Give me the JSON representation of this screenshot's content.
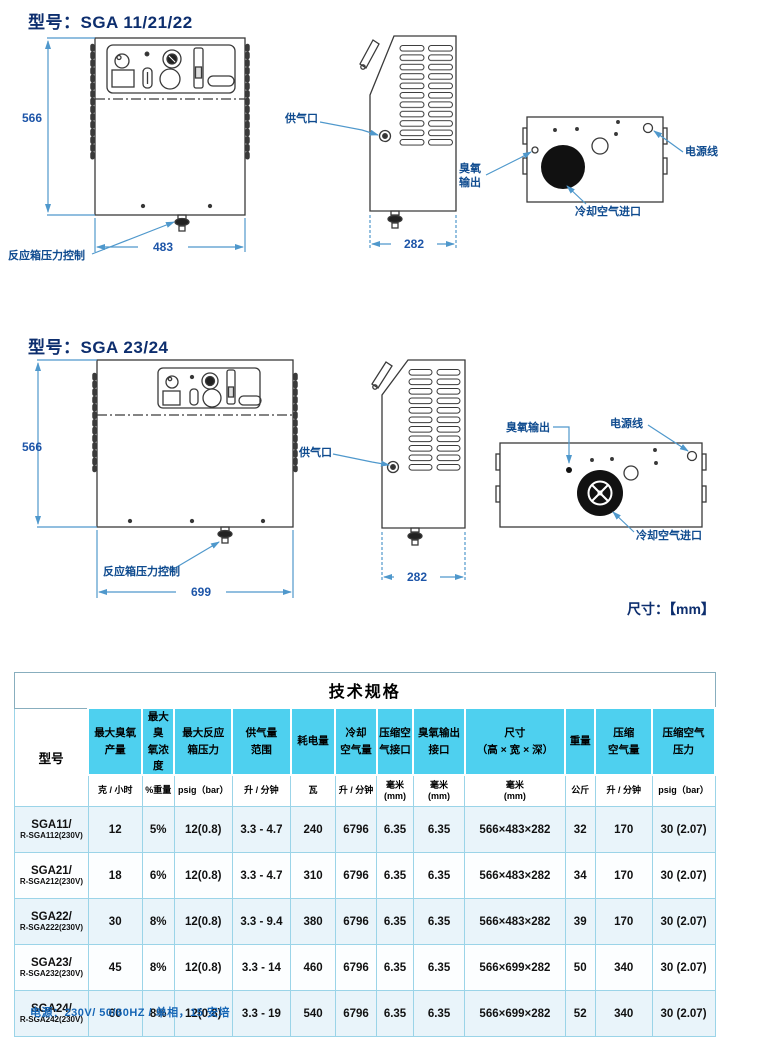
{
  "section1": {
    "title": "型号：SGA 11/21/22",
    "dim_height": "566",
    "dim_width": "483",
    "dim_depth": "282",
    "label_pressure": "反应箱压力控制",
    "label_air_inlet": "供气口",
    "label_ozone_out": "臭氧\n输出",
    "label_power_cord": "电源线",
    "label_cooling_inlet": "冷却空气进口"
  },
  "section2": {
    "title": "型号：SGA 23/24",
    "dim_height": "566",
    "dim_width": "699",
    "dim_depth": "282",
    "label_pressure": "反应箱压力控制",
    "label_air_inlet": "供气口",
    "label_ozone_out": "臭氧输出",
    "label_power_cord": "电源线",
    "label_cooling_inlet": "冷却空气进口"
  },
  "units_note": "尺寸：【mm】",
  "table": {
    "title": "技术规格",
    "columns": [
      {
        "name": "型号",
        "unit": ""
      },
      {
        "name": "最大臭氧\n产量",
        "unit": "克 / 小时"
      },
      {
        "name": "最大臭\n氧浓度",
        "unit": "%重量"
      },
      {
        "name": "最大反应\n箱压力",
        "unit": "psig（bar）"
      },
      {
        "name": "供气量\n范围",
        "unit": "升 / 分钟"
      },
      {
        "name": "耗电量",
        "unit": "瓦"
      },
      {
        "name": "冷却\n空气量",
        "unit": "升 / 分钟"
      },
      {
        "name": "压缩空\n气接口",
        "unit": "毫米\n(mm)"
      },
      {
        "name": "臭氧输出\n接口",
        "unit": "毫米\n(mm)"
      },
      {
        "name": "尺寸\n（高 × 宽 × 深）",
        "unit": "毫米\n(mm)"
      },
      {
        "name": "重量",
        "unit": "公斤"
      },
      {
        "name": "压缩\n空气量",
        "unit": "升 / 分钟"
      },
      {
        "name": "压缩空气\n压力",
        "unit": "psig（bar）"
      }
    ],
    "rows": [
      {
        "model_line1": "SGA11/",
        "model_line2": "R-SGA112(230V)",
        "values": [
          "12",
          "5%",
          "12(0.8)",
          "3.3 - 4.7",
          "240",
          "6796",
          "6.35",
          "6.35",
          "566×483×282",
          "32",
          "170",
          "30 (2.07)"
        ]
      },
      {
        "model_line1": "SGA21/",
        "model_line2": "R-SGA212(230V)",
        "values": [
          "18",
          "6%",
          "12(0.8)",
          "3.3 - 4.7",
          "310",
          "6796",
          "6.35",
          "6.35",
          "566×483×282",
          "34",
          "170",
          "30 (2.07)"
        ]
      },
      {
        "model_line1": "SGA22/",
        "model_line2": "R-SGA222(230V)",
        "values": [
          "30",
          "8%",
          "12(0.8)",
          "3.3 - 9.4",
          "380",
          "6796",
          "6.35",
          "6.35",
          "566×483×282",
          "39",
          "170",
          "30 (2.07)"
        ]
      },
      {
        "model_line1": "SGA23/",
        "model_line2": "R-SGA232(230V)",
        "values": [
          "45",
          "8%",
          "12(0.8)",
          "3.3 - 14",
          "460",
          "6796",
          "6.35",
          "6.35",
          "566×699×282",
          "50",
          "340",
          "30 (2.07)"
        ]
      },
      {
        "model_line1": "SGA24/",
        "model_line2": "R-SGA242(230V)",
        "values": [
          "60",
          "8%",
          "12(0.8)",
          "3.3 - 19",
          "540",
          "6796",
          "6.35",
          "6.35",
          "566×699×282",
          "52",
          "340",
          "30 (2.07)"
        ]
      }
    ]
  },
  "footer_note": "电源：230V/ 50/60HZ / 单相，15 安培",
  "colors": {
    "title_blue": "#0d2e6e",
    "label_blue": "#0f4b8f",
    "dim_blue": "#1d55a8",
    "leader_blue": "#4f98cc",
    "header_cyan": "#4ed0ef",
    "table_border": "#9bd4e8",
    "footer_blue": "#1565b5"
  }
}
